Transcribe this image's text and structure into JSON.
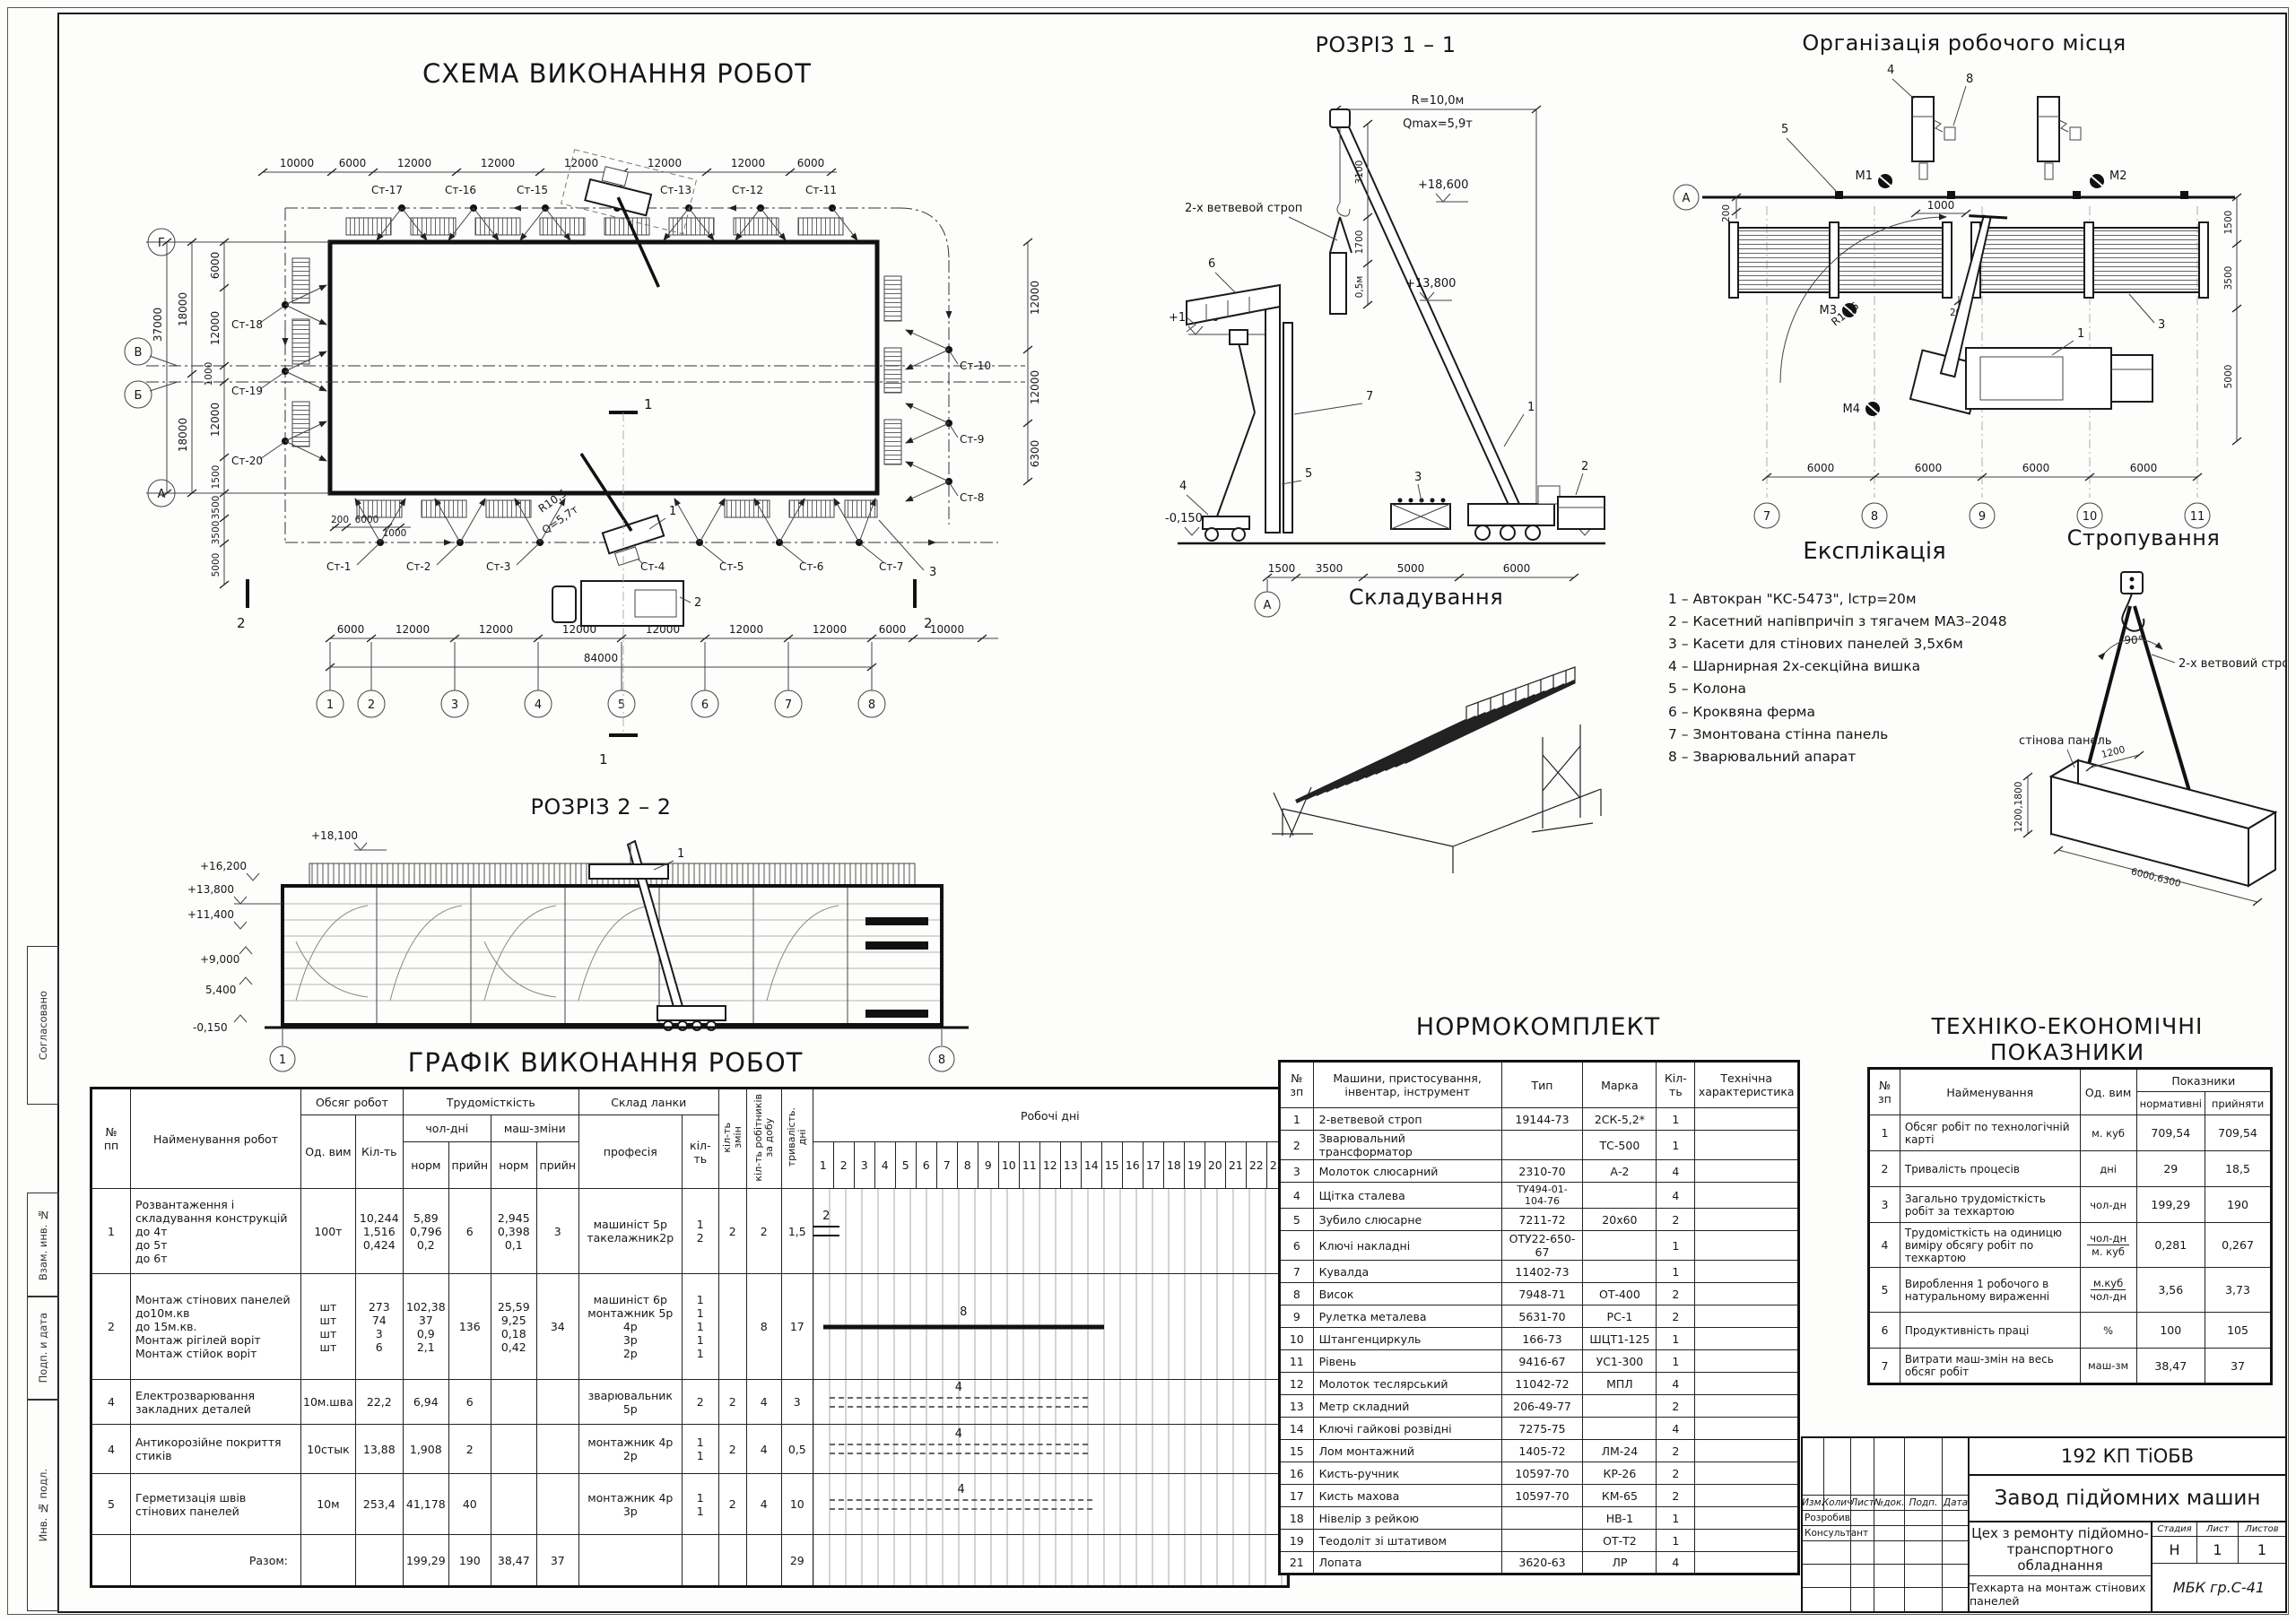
{
  "sheet": {
    "left_stamps": [
      "Согласовано",
      "Взам. инв. №",
      "Подп. и дата",
      "Инв. № подл."
    ]
  },
  "plan": {
    "title": "СХЕМА ВИКОНАННЯ РОБОТ",
    "grid_g": "Г",
    "grid_v": "В",
    "grid_b": "Б",
    "grid_a": "А",
    "grid_cols": [
      "1",
      "2",
      "3",
      "4",
      "5",
      "6",
      "7",
      "8"
    ],
    "dims_top": [
      "10000",
      "6000",
      "12000",
      "12000",
      "12000",
      "12000",
      "12000",
      "6000"
    ],
    "dims_left_outer": [
      "18000",
      "18000"
    ],
    "dim_left_total": "37000",
    "dims_left_inner": [
      "6000",
      "12000",
      "1000",
      "12000",
      "1500"
    ],
    "dims_left_lower": [
      "3500",
      "3500",
      "5000"
    ],
    "dims_bottom": [
      "6000",
      "12000",
      "12000",
      "12000",
      "12000",
      "12000",
      "12000",
      "6000",
      "10000"
    ],
    "dim_total": "84000",
    "dims_right": [
      "12000",
      "12000",
      "6300"
    ],
    "dims_small": [
      "200",
      "6000",
      "1000"
    ],
    "stops_top": [
      "Ст-17",
      "Ст-16",
      "Ст-15",
      "Ст-14",
      "Ст-13",
      "Ст-12",
      "Ст-11"
    ],
    "stops_left": [
      "Ст-18",
      "Ст-19",
      "Ст-20"
    ],
    "stops_bottom": [
      "Ст-1",
      "Ст-2",
      "Ст-3",
      "Ст-4",
      "Ст-5",
      "Ст-6",
      "Ст-7"
    ],
    "stops_right": [
      "Ст-10",
      "Ст-9",
      "Ст-8"
    ],
    "crane_radius": "R10,5",
    "crane_capacity": "Q=5,7т",
    "sec1": "1",
    "sec2": "2",
    "callout1": "1",
    "callout2": "2",
    "callout3": "3"
  },
  "rozriz1": {
    "title": "РОЗРІЗ 1 – 1",
    "dim_radius": "R=10,0м",
    "dim_qmax": "Qmax=5,9т",
    "elev_18600": "+18,600",
    "elev_13800": "+13,800",
    "elev_12000": "+12,000",
    "elev_m1": "-0,150",
    "elev_m2": "-0,150",
    "sling_label": "2-х ветвевой строп",
    "dim_3100": "3100",
    "dim_1700": "1700",
    "dim_05": "0,5м",
    "dims_bottom": [
      "1500",
      "3500",
      "5000",
      "6000"
    ],
    "grid_a": "А",
    "c1": "1",
    "c2": "2",
    "c3": "3",
    "c4": "4",
    "c5": "5",
    "c6": "6",
    "c7": "7"
  },
  "workplace": {
    "title": "Організація робочого місця",
    "grid_a": "А",
    "grid_cols": [
      "7",
      "8",
      "9",
      "10",
      "11"
    ],
    "dims_bottom": [
      "6000",
      "6000",
      "6000",
      "6000"
    ],
    "dims_right": [
      "1500",
      "3500",
      "5000"
    ],
    "dim_200a": "200",
    "dim_200b": "200",
    "dim_1000": "1000",
    "radius": "R10,5",
    "m1": "М1",
    "m2": "М2",
    "m3": "М3",
    "m4": "М4",
    "c1": "1",
    "c3": "3",
    "c4": "4",
    "c5": "5",
    "c8": "8"
  },
  "rozriz2": {
    "title": "РОЗРІЗ 2 – 2",
    "elev_18100": "+18,100",
    "elev_16200": "+16,200",
    "elev_13800": "+13,800",
    "elev_11400": "+11,400",
    "elev_9000": "+9,000",
    "elev_5400": "5,400",
    "elev_m": "-0,150",
    "g1": "1",
    "g8": "8",
    "c1": "1"
  },
  "stacking": {
    "title": "Складування"
  },
  "explication": {
    "title": "Експлікація",
    "items": [
      "1 –  Автокран \"КС-5473\",  lстр=20м",
      "2 – Касетний напівпричіп з тягачем МАЗ–2048",
      "3 – Касети для стінових панелей 3,5х6м",
      "4 – Шарнирная 2х-секційна вишка",
      "5 – Колона",
      "6 – Кроквяна ферма",
      "7 – Змонтована стінна панель",
      "8 – Зварювальний апарат"
    ]
  },
  "sling": {
    "title": "Стропування",
    "angle": "90°",
    "label": "2-х ветвовий строп",
    "panel": "стінова панель",
    "dim_top": "1200",
    "dim_h": "1200,1800",
    "dim_l": "6000,6300"
  },
  "schedule": {
    "title": "ГРАФІК ВИКОНАННЯ  РОБОТ",
    "h_num": "№\nпп",
    "h_name": "Найменування робот",
    "h_volume": "Обсяг робот",
    "h_unit": "Од. вим",
    "h_qty": "Кіл-ть",
    "h_labor": "Трудомісткість",
    "h_ch": "чол-дні",
    "h_mash": "маш-зміни",
    "h_norm": "норм",
    "h_pri": "прийн",
    "h_norm2": "норм",
    "h_pri2": "прийн",
    "h_crew": "Склад ланки",
    "h_prof": "професія",
    "h_crew_qty": "кіл-\nть",
    "h_shifts": "кіл-ть\nзмін",
    "h_workers": "кіл-ть робітників\nза добу",
    "h_dur": "тривалість.\nдні",
    "h_days": "Робочі дні",
    "days": [
      "1",
      "2",
      "3",
      "4",
      "5",
      "6",
      "7",
      "8",
      "9",
      "10",
      "11",
      "12",
      "13",
      "14",
      "15",
      "16",
      "17",
      "18",
      "19",
      "20",
      "21",
      "22",
      "23"
    ],
    "rows": [
      {
        "num": "1",
        "name": "Розвантаження і складування конструкцій\nдо 4т\nдо 5т\nдо 6т",
        "unit": "100т",
        "qty": "10,244\n1,516\n0,424",
        "chn": "5,89\n0,796\n0,2",
        "chp": "6",
        "mn": "2,945\n0,398\n0,1",
        "mp": "3",
        "prof": "машиніст 5р\nтакелажник2р",
        "pq": "1\n2",
        "sh": "2",
        "wk": "2",
        "dur": "1,5",
        "h": 95,
        "bar": {
          "s": 1,
          "l": 1.6,
          "style": "double",
          "label": "2"
        }
      },
      {
        "num": "2",
        "name": "Монтаж стінових панелей\nдо10м.кв\nдо 15м.кв.\nМонтаж рігілей воріт\nМонтаж стійок воріт",
        "unit": "шт\nшт\nшт\nшт",
        "qty": "273\n74\n3\n6",
        "chn": "102,38\n37\n0,9\n2,1",
        "chp": "136",
        "mn": "25,59\n9,25\n0,18\n0,42",
        "mp": "34",
        "prof": "машиніст 6р\nмонтажник 5р\n4р\n3р\n2р",
        "pq": "1\n1\n1\n1\n1",
        "sh": "",
        "wk": "8",
        "dur": "17",
        "h": 118,
        "bar": {
          "s": 1.6,
          "l": 17.4,
          "style": "solid",
          "label": "8"
        }
      },
      {
        "num": "4",
        "name": "Електрозварювання закладних деталей",
        "unit": "10м.шва",
        "qty": "22,2",
        "chn": "6,94",
        "chp": "6",
        "mn": "",
        "mp": "",
        "prof": "зварювальник 5р",
        "pq": "2",
        "sh": "2",
        "wk": "4",
        "dur": "3",
        "h": 50,
        "bar": {
          "s": 2,
          "l": 16,
          "style": "dashed",
          "label": "4"
        }
      },
      {
        "num": "4",
        "name": "Антикорозійне покриття стиків",
        "unit": "10стык",
        "qty": "13,88",
        "chn": "1,908",
        "chp": "2",
        "mn": "",
        "mp": "",
        "prof": "монтажник 4р\n2р",
        "pq": "1\n1",
        "sh": "2",
        "wk": "4",
        "dur": "0,5",
        "h": 55,
        "bar": {
          "s": 2,
          "l": 16,
          "style": "dashed",
          "label": "4"
        }
      },
      {
        "num": "5",
        "name": "Герметизація швів стінових панелей",
        "unit": "10м",
        "qty": "253,4",
        "chn": "41,178",
        "chp": "40",
        "mn": "",
        "mp": "",
        "prof": "монтажник 4р\n3р",
        "pq": "1\n1",
        "sh": "2",
        "wk": "4",
        "dur": "10",
        "h": 68,
        "bar": {
          "s": 2,
          "l": 16.3,
          "style": "dashed",
          "label": "4"
        }
      },
      {
        "num": "",
        "name": "Разом:",
        "unit": "",
        "qty": "",
        "chn": "199,29",
        "chp": "190",
        "mn": "38,47",
        "mp": "37",
        "prof": "",
        "pq": "",
        "sh": "",
        "wk": "",
        "dur": "29",
        "h": 58,
        "total": true
      }
    ]
  },
  "norm": {
    "title": "НОРМОКОМПЛЕКТ",
    "headers": [
      "№\nзп",
      "Машини, пристосування,\nінвентар, інструмент",
      "Тип",
      "Марка",
      "Кіл-ть",
      "Технічна\nхарактеристика"
    ],
    "rows": [
      [
        "1",
        "2-ветвевой строп",
        "19144-73",
        "2СК-5,2*",
        "1",
        ""
      ],
      [
        "2",
        "Зварювальний трансформатор",
        "",
        "ТС-500",
        "1",
        ""
      ],
      [
        "3",
        "Молоток слюсарний",
        "2310-70",
        "А-2",
        "4",
        ""
      ],
      [
        "4",
        "Щітка сталева",
        "ТУ494-01-\n104-76",
        "",
        "4",
        ""
      ],
      [
        "5",
        "Зубило слюсарне",
        "7211-72",
        "20х60",
        "2",
        ""
      ],
      [
        "6",
        "Ключі накладні",
        "ОТУ22-650-67",
        "",
        "1",
        ""
      ],
      [
        "7",
        "Кувалда",
        "11402-73",
        "",
        "1",
        ""
      ],
      [
        "8",
        "Висок",
        "7948-71",
        "ОТ-400",
        "2",
        ""
      ],
      [
        "9",
        "Рулетка металева",
        "5631-70",
        "РС-1",
        "2",
        ""
      ],
      [
        "10",
        "Штангенциркуль",
        "166-73",
        "ШЦТ1-125",
        "1",
        ""
      ],
      [
        "11",
        "Рівень",
        "9416-67",
        "УС1-300",
        "1",
        ""
      ],
      [
        "12",
        "Молоток теслярський",
        "11042-72",
        "МПЛ",
        "4",
        ""
      ],
      [
        "13",
        "Метр складний",
        "206-49-77",
        "",
        "2",
        ""
      ],
      [
        "14",
        "Ключі гайкові розвідні",
        "7275-75",
        "",
        "4",
        ""
      ],
      [
        "15",
        "Лом монтажний",
        "1405-72",
        "ЛМ-24",
        "2",
        ""
      ],
      [
        "16",
        "Кисть-ручник",
        "10597-70",
        "КР-26",
        "2",
        ""
      ],
      [
        "17",
        "Кисть махова",
        "10597-70",
        "КМ-65",
        "2",
        ""
      ],
      [
        "18",
        "Нівелір з рейкою",
        "",
        "НВ-1",
        "1",
        ""
      ],
      [
        "19",
        "Теодоліт зі штативом",
        "",
        "ОТ-Т2",
        "1",
        ""
      ],
      [
        "21",
        "Лопата",
        "3620-63",
        "ЛР",
        "4",
        ""
      ]
    ]
  },
  "tep": {
    "title": "ТЕХНІКО-ЕКОНОМІЧНІ ПОКАЗНИКИ",
    "h_num": "№\nзп",
    "h_name": "Найменування",
    "h_unit": "Од. вим",
    "h_ind": "Показники",
    "h_norm": "нормативні",
    "h_adopt": "прийняти",
    "rows": [
      {
        "n": "1",
        "name": "Обсяг робіт по технологічній карті",
        "unit": "м. куб",
        "norm": "709,54",
        "adopt": "709,54"
      },
      {
        "n": "2",
        "name": "Тривалість процесів",
        "unit": "дні",
        "norm": "29",
        "adopt": "18,5"
      },
      {
        "n": "3",
        "name": "Загально трудомісткість робіт за техкартою",
        "unit": "чол-дн",
        "norm": "199,29",
        "adopt": "190"
      },
      {
        "n": "4",
        "name": "Трудомісткість на одиницю виміру обсягу робіт по техкартою",
        "unit": "чол-дн",
        "unit2": "м. куб",
        "norm": "0,281",
        "adopt": "0,267"
      },
      {
        "n": "5",
        "name": "Вироблення 1 робочого в натуральному вираженні",
        "unit": "м.куб",
        "unit2": "чол-дн",
        "norm": "3,56",
        "adopt": "3,73"
      },
      {
        "n": "6",
        "name": "Продуктивність праці",
        "unit": "%",
        "norm": "100",
        "adopt": "105"
      },
      {
        "n": "7",
        "name": "Витрати маш-змін на весь обсяг робіт",
        "unit": "маш-зм",
        "norm": "38,47",
        "adopt": "37"
      }
    ]
  },
  "titleblock": {
    "code": "192 КП ТіОБВ",
    "org": "Завод підйомних машин",
    "cols": [
      "Изм.",
      "Колич",
      "Лист",
      "№док.",
      "Подп.",
      "Дата"
    ],
    "role1": "Розробив",
    "role2": "Консультант",
    "object": "Цех з ремонту підйомно-\nтранспортного обладнання",
    "h_stage": "Стадия",
    "h_sheet": "Лист",
    "h_sheets": "Листов",
    "stage": "Н",
    "sheet": "1",
    "sheets": "1",
    "subject": "Техкарта на монтаж стінових панелей",
    "group": "МБК гр.С-41"
  }
}
